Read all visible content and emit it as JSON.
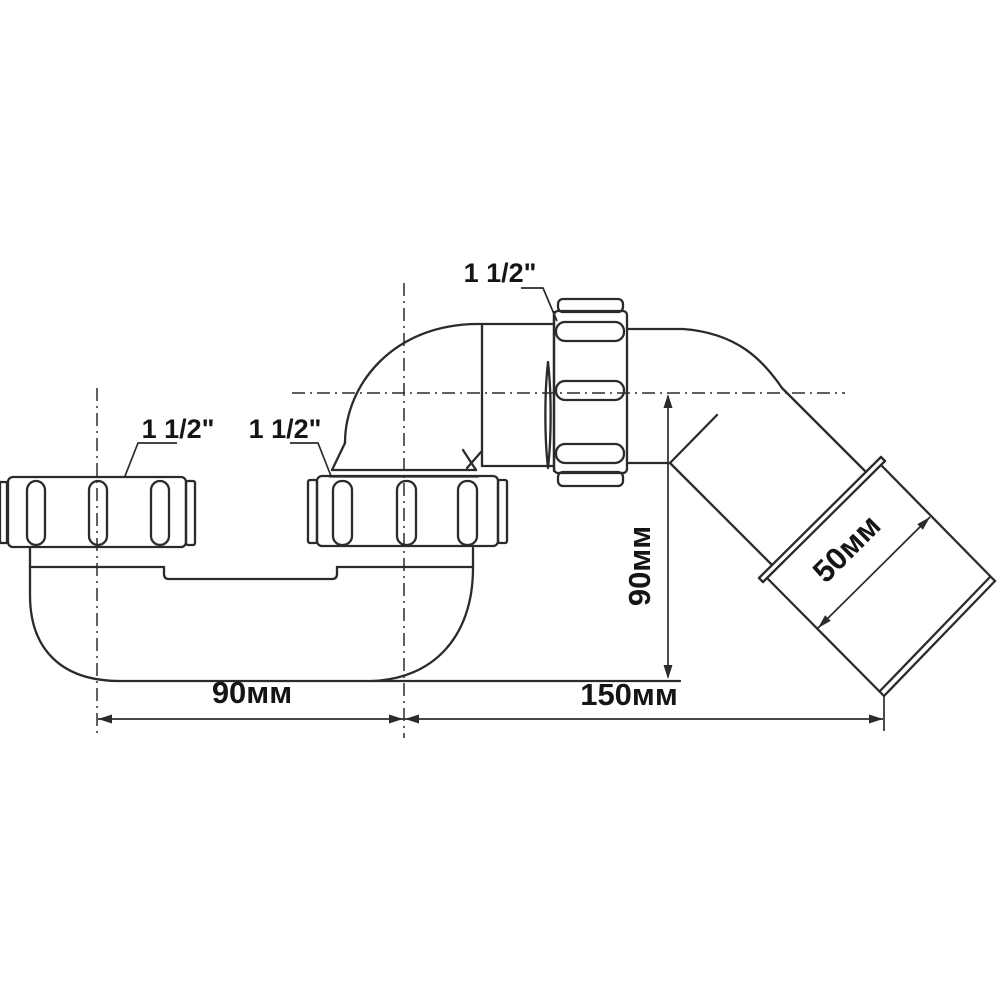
{
  "drawing": {
    "type": "technical-dimension-drawing",
    "subject": "pipe-trap-siphon",
    "colors": {
      "line": "#2b2b2b",
      "text": "#151515",
      "background": "#ffffff"
    },
    "labels": {
      "thread_size_left": "1 1/2\"",
      "thread_size_middle": "1 1/2\"",
      "thread_size_top": "1 1/2\""
    },
    "dimensions": {
      "bottom_left_width": "90мм",
      "bottom_right_width": "150мм",
      "trap_height": "90мм",
      "outlet_diameter": "50мм"
    }
  }
}
